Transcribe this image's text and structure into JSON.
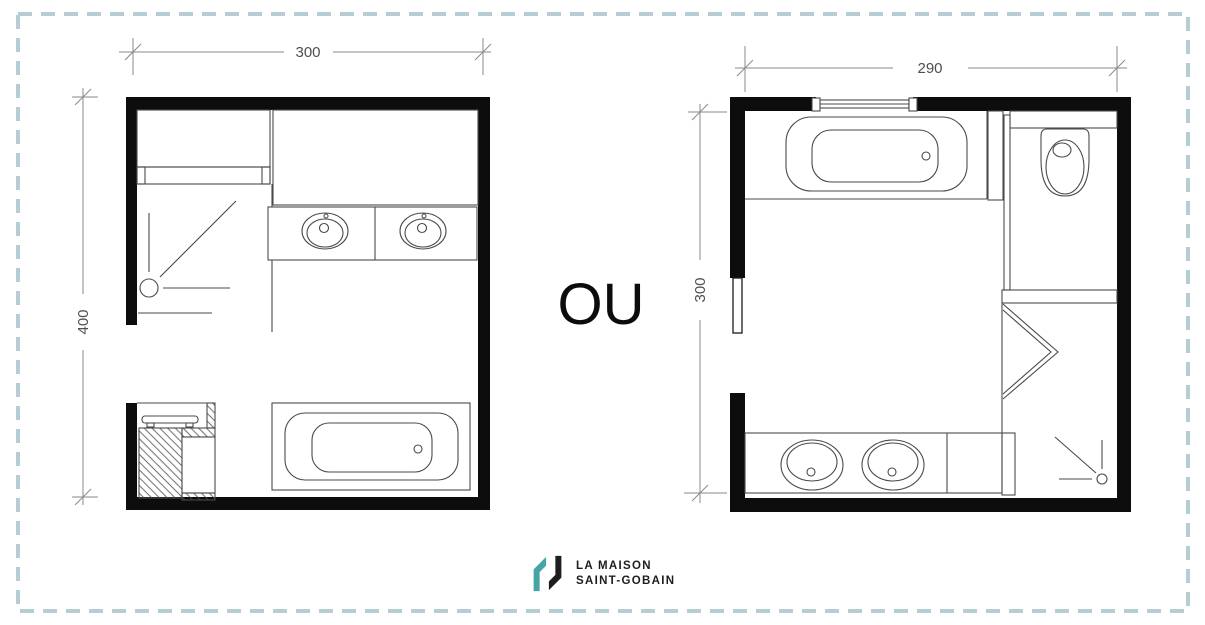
{
  "page": {
    "background": "#ffffff",
    "frame_color": "#b7cdd6",
    "wall_color": "#0d0d0d",
    "line_color": "#4a4a4a",
    "dim_color": "#8a8a8a"
  },
  "separator": {
    "label": "OU"
  },
  "plan_left": {
    "width_cm": "300",
    "height_cm": "400",
    "fixtures": [
      "hatched-storage-zone",
      "shelf-niche",
      "corner-shower",
      "double-washbasin-vanity",
      "towel-radiator",
      "cabinet-niche",
      "bathtub",
      "door-opening"
    ]
  },
  "plan_right": {
    "width_cm": "290",
    "height_cm": "300",
    "fixtures": [
      "window",
      "bathtub",
      "toilet-compartment",
      "toilet",
      "sliding-partition",
      "folding-shower-door",
      "corner-shower",
      "double-washbasin-vanity",
      "door-opening"
    ]
  },
  "logo": {
    "line1": "LA MAISON",
    "line2": "SAINT-GOBAIN",
    "teal": "#45a4a4",
    "black": "#1d1d1b"
  }
}
